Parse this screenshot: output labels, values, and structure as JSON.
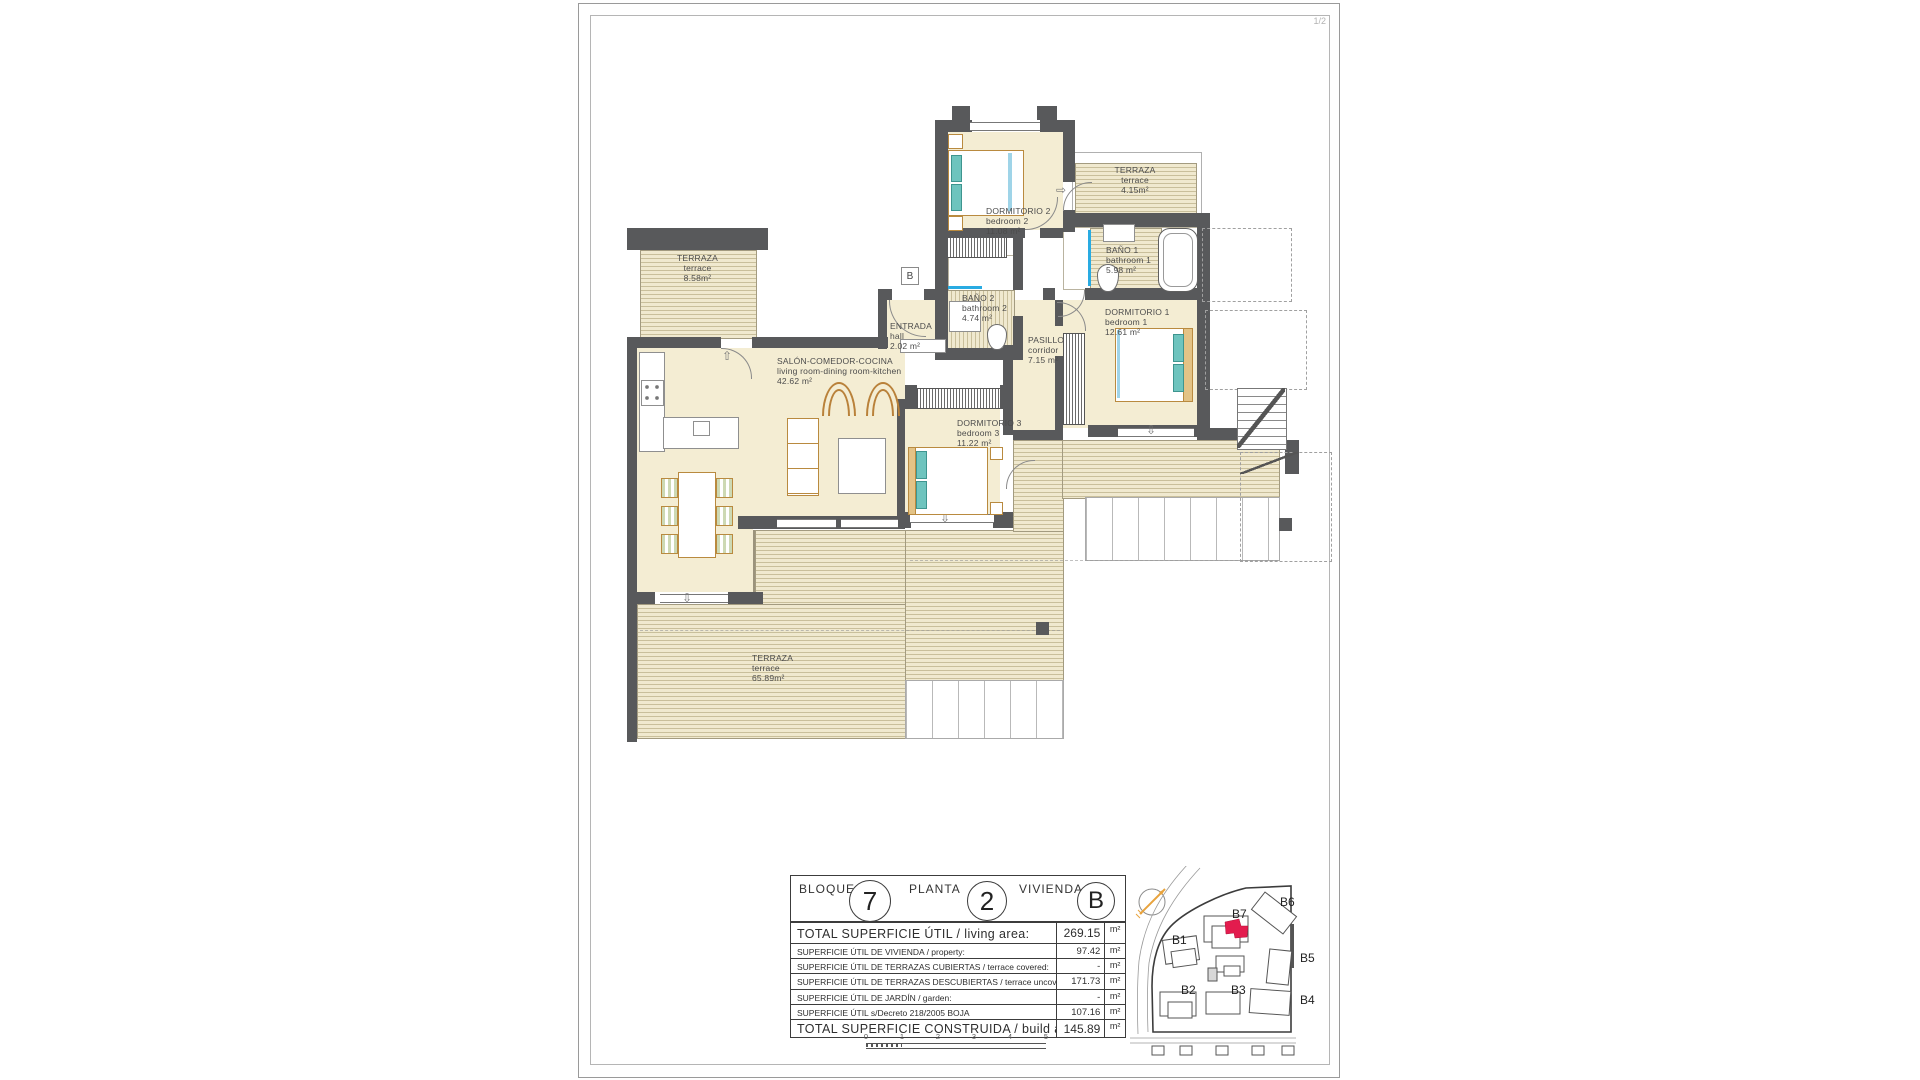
{
  "page": {
    "number": "1/2"
  },
  "plan": {
    "unit_badge": "B",
    "rooms": {
      "dormitorio2": {
        "name": "DORMITORIO 2",
        "subtitle": "bedroom 2",
        "area": "11.08 m²"
      },
      "dormitorio1": {
        "name": "DORMITORIO 1",
        "subtitle": "bedroom 1",
        "area": "12.61 m²"
      },
      "dormitorio3": {
        "name": "DORMITORIO 3",
        "subtitle": "bedroom 3",
        "area": "11.22 m²"
      },
      "bano1": {
        "name": "BAÑO 1",
        "subtitle": "bathroom 1",
        "area": "5.98 m²"
      },
      "bano2": {
        "name": "BAÑO 2",
        "subtitle": "bathroom 2",
        "area": "4.74 m²"
      },
      "entrada": {
        "name": "ENTRADA",
        "subtitle": "hall",
        "area": "2.02 m²"
      },
      "pasillo": {
        "name": "PASILLO",
        "subtitle": "corridor",
        "area": "7.15 m²"
      },
      "salon": {
        "name": "SALÓN-COMEDOR-COCINA",
        "subtitle": "living room-dining room-kitchen",
        "area": "42.62 m²"
      },
      "terraza_nw": {
        "name": "TERRAZA",
        "subtitle": "terrace",
        "area": "8.58m²"
      },
      "terraza_ne": {
        "name": "TERRAZA",
        "subtitle": "terrace",
        "area": "4.15m²"
      },
      "terraza_main": {
        "name": "TERRAZA",
        "subtitle": "terrace",
        "area": "65.89m²"
      }
    }
  },
  "info_table": {
    "header": {
      "bloque_label": "BLOQUE",
      "bloque_value": "7",
      "planta_label": "PLANTA",
      "planta_value": "2",
      "vivienda_label": "VIVIENDA",
      "vivienda_value": "B"
    },
    "rows": [
      {
        "label": "TOTAL SUPERFICIE ÚTIL / living area:",
        "value": "269.15",
        "unit": "m²"
      },
      {
        "label": "SUPERFICIE ÚTIL DE VIVIENDA / property:",
        "value": "97.42",
        "unit": "m²"
      },
      {
        "label": "SUPERFICIE ÚTIL DE TERRAZAS CUBIERTAS / terrace covered:",
        "value": "-",
        "unit": "m²"
      },
      {
        "label": "SUPERFICIE ÚTIL DE TERRAZAS DESCUBIERTAS / terrace uncovered:",
        "value": "171.73",
        "unit": "m²"
      },
      {
        "label": "SUPERFICIE ÚTIL DE JARDÍN / garden:",
        "value": "-",
        "unit": "m²"
      },
      {
        "label": "SUPERFICIE ÚTIL s/Decreto 218/2005 BOJA",
        "value": "107.16",
        "unit": "m²"
      },
      {
        "label": "TOTAL SUPERFICIE CONSTRUIDA / build area:",
        "value": "145.89",
        "unit": "m²"
      }
    ]
  },
  "scale_bar": {
    "ticks": [
      "0",
      "1",
      "2",
      "3",
      "4",
      "5"
    ]
  },
  "site_plan": {
    "labels": {
      "b1": "B1",
      "b2": "B2",
      "b3": "B3",
      "b4": "B4",
      "b5": "B5",
      "b6": "B6",
      "b7": "B7"
    },
    "highlight_color": "#e31c4e"
  },
  "colors": {
    "wall": "#58595b",
    "room_fill": "#f4edd3",
    "terrace_stripe": "#c9bf9b",
    "highlight": "#e31c4e",
    "pillow": "#6ec4be",
    "wood": "#b98a3f",
    "shower_glass": "#29abe2",
    "compass_needle": "#e8a33d"
  }
}
